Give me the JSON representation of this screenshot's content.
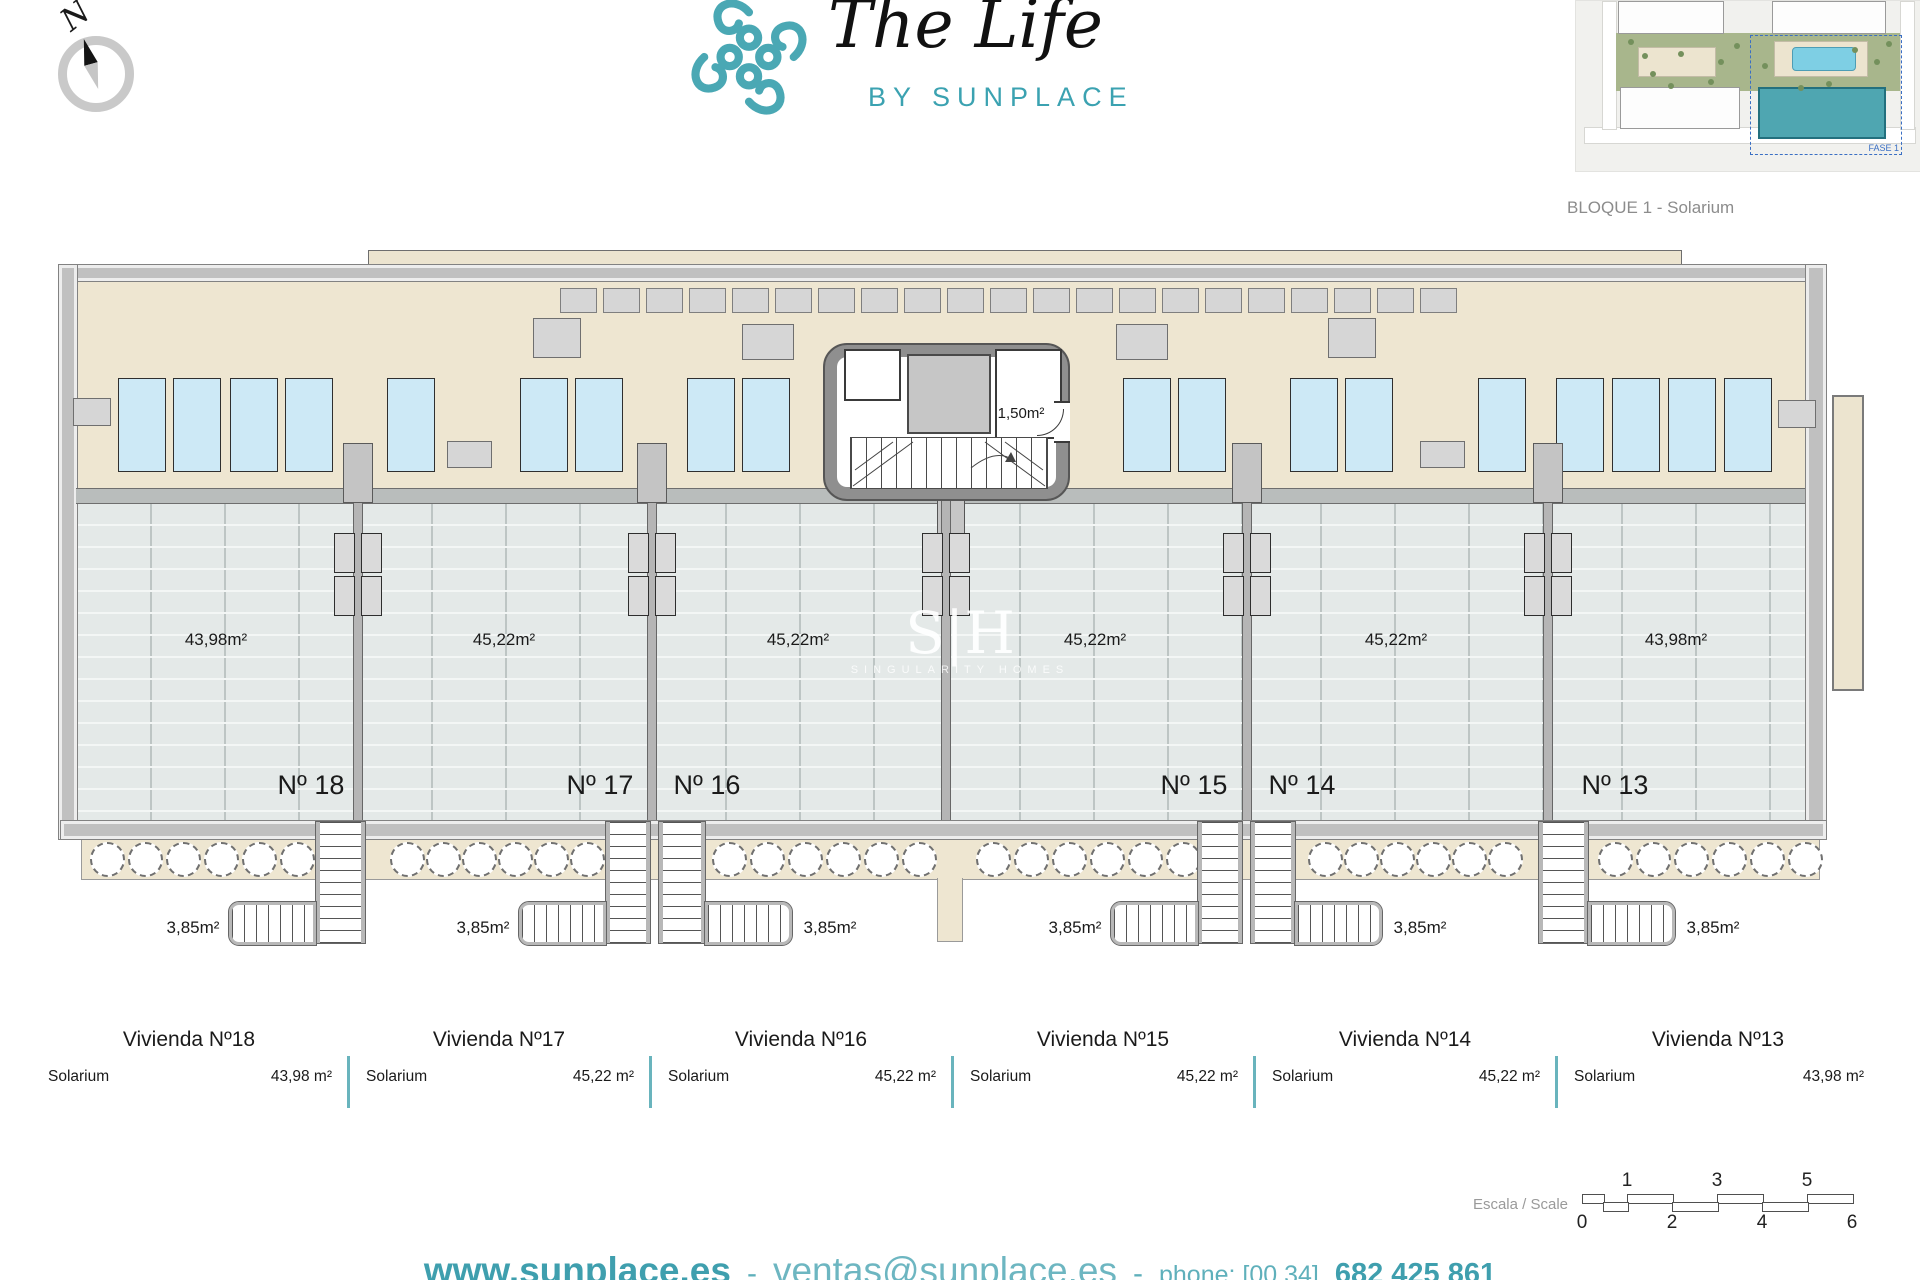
{
  "brand": {
    "title": "The Life",
    "subtitle": "BY SUNPLACE"
  },
  "compass": {
    "north_label": "N"
  },
  "sitemap": {
    "caption": "BLOQUE 1 - Solarium",
    "fase_label": "FASE 1"
  },
  "plan": {
    "core_area_label": "1,50m²",
    "stair_area_label": "3,85m²",
    "terraces": [
      {
        "unit": "Nº 18",
        "area": "43,98m²"
      },
      {
        "unit": "Nº 17",
        "area": "45,22m²"
      },
      {
        "unit": "Nº 16",
        "area": "45,22m²"
      },
      {
        "unit": "Nº 15",
        "area": "45,22m²"
      },
      {
        "unit": "Nº 14",
        "area": "45,22m²"
      },
      {
        "unit": "Nº 13",
        "area": "43,98m²"
      }
    ]
  },
  "watermark": {
    "initials": "S|H",
    "name": "SINGULARITY HOMES"
  },
  "table": {
    "columns": [
      {
        "title": "Vivienda Nº18",
        "label": "Solarium",
        "value": "43,98 m²"
      },
      {
        "title": "Vivienda Nº17",
        "label": "Solarium",
        "value": "45,22 m²"
      },
      {
        "title": "Vivienda Nº16",
        "label": "Solarium",
        "value": "45,22 m²"
      },
      {
        "title": "Vivienda Nº15",
        "label": "Solarium",
        "value": "45,22 m²"
      },
      {
        "title": "Vivienda Nº14",
        "label": "Solarium",
        "value": "45,22 m²"
      },
      {
        "title": "Vivienda Nº13",
        "label": "Solarium",
        "value": "43,98 m²"
      }
    ]
  },
  "scalebar": {
    "label": "Escala / Scale",
    "ticks_above": [
      "1",
      "3",
      "5"
    ],
    "ticks_below": [
      "0",
      "2",
      "4",
      "6"
    ]
  },
  "footer": {
    "website": "www.sunplace.es",
    "separator": "-",
    "email": "ventas@sunplace.es",
    "phone_prefix": "phone: [00 34]",
    "phone_number": "682 425 861"
  },
  "colors": {
    "teal": "#4aa8b4",
    "deck_beige": "#eee6d1",
    "terrace_grey": "#e4e9e8",
    "pool_blue": "#cde9f6",
    "table_divider": "#69b4bd"
  }
}
